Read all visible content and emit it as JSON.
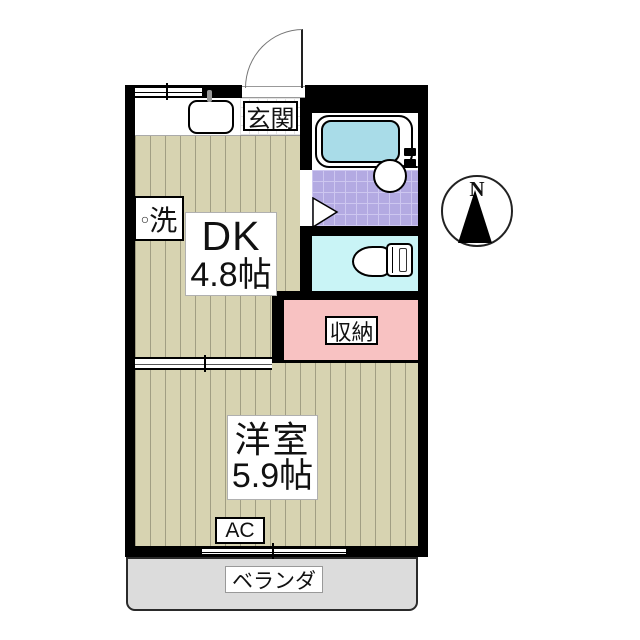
{
  "type": "apartment-floor-plan",
  "compass": {
    "north_label": "N"
  },
  "rooms": {
    "entrance": {
      "label": "玄関"
    },
    "dk": {
      "name": "DK",
      "size": "4.8帖"
    },
    "washer": {
      "symbol": "○",
      "label": "洗"
    },
    "storage": {
      "label": "収納"
    },
    "western_room": {
      "name": "洋室",
      "size": "5.9帖"
    },
    "ac_unit": {
      "label": "AC"
    },
    "veranda": {
      "label": "ベランダ"
    }
  },
  "colors": {
    "wall": "#000000",
    "floor": "#d7d3b1",
    "floorline": "#a19e83",
    "washroom": "#b3aae2",
    "washroomline": "#cdc7f0",
    "toiletroom": "#c9f4f6",
    "bathtub": "#a9dce8",
    "storage": "#f8c2c2",
    "veranda": "#dcdcdc",
    "tile": "#e3e3e3"
  }
}
